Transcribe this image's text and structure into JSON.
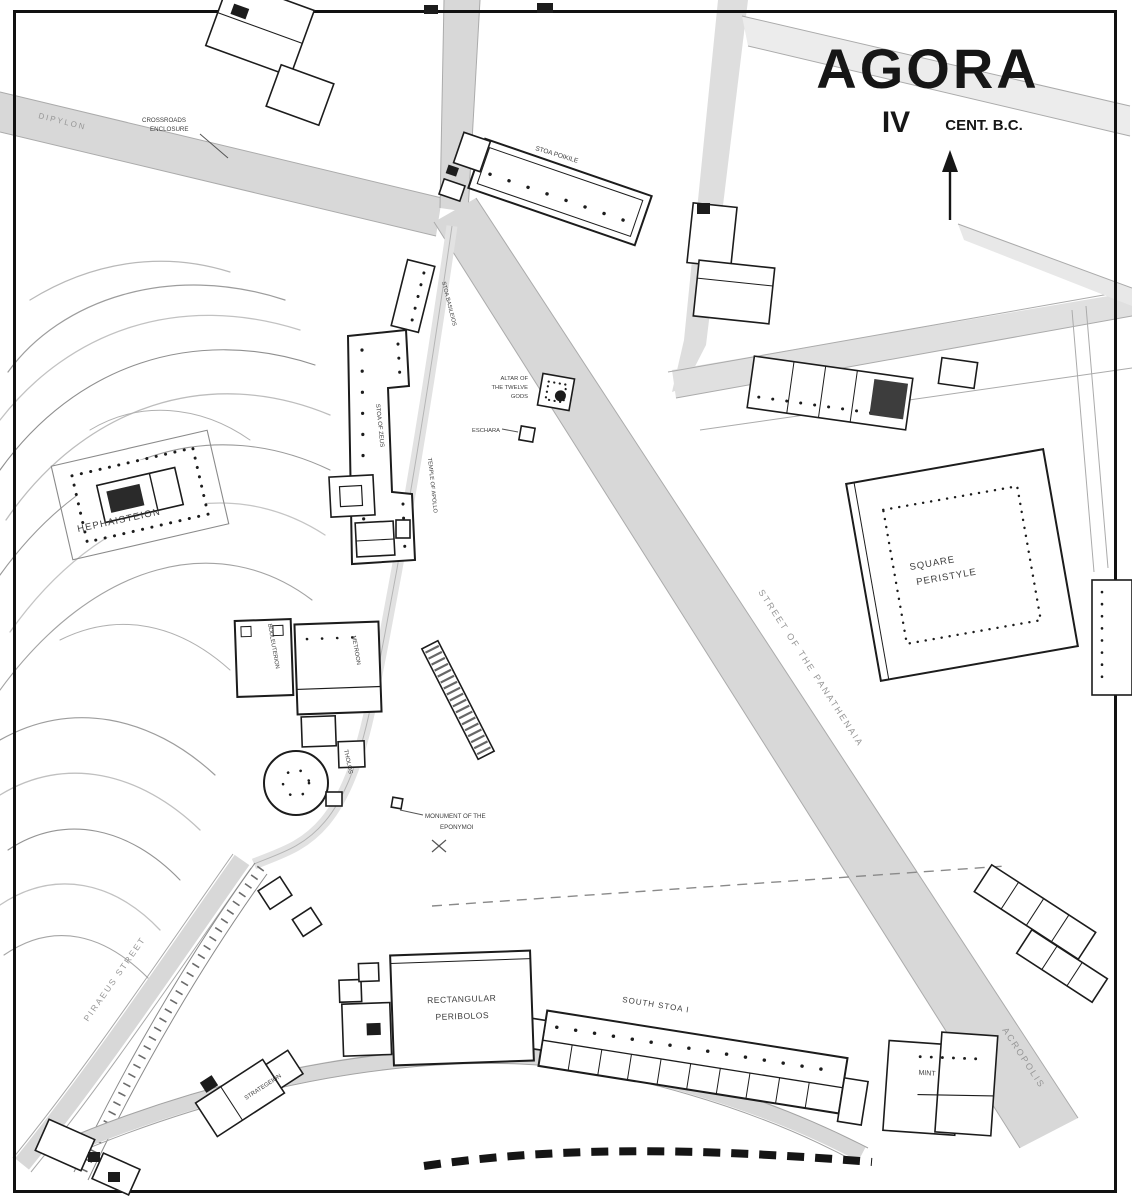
{
  "title": {
    "main": "AGORA",
    "century": "IV",
    "cent_suffix": "CENT. B.C."
  },
  "labels": {
    "crossroads_1": "CROSSROADS",
    "crossroads_2": "ENCLOSURE",
    "stoa_poikile": "STOA POIKILE",
    "stoa_basileios": "STOA BASILEIOS",
    "altar_1": "ALTAR OF",
    "altar_2": "THE TWELVE",
    "altar_3": "GODS",
    "eschara": "ESCHARA",
    "stoa_of_zeus": "STOA OF ZEUS",
    "apollo_patroos": "TEMPLE OF APOLLO",
    "metroon": "METROON",
    "bouleuterion": "BOULEUTERION",
    "tholos": "THOLOS",
    "eponymoi_1": "MONUMENT OF THE",
    "eponymoi_2": "EPONYMOI",
    "hephaisteion": "HEPHAISTEION",
    "square_peristyle_1": "SQUARE",
    "square_peristyle_2": "PERISTYLE",
    "peribolos_1": "RECTANGULAR",
    "peribolos_2": "PERIBOLOS",
    "south_stoa": "SOUTH STOA I",
    "mint": "MINT",
    "strategeion": "STRATEGEION"
  },
  "street_labels": {
    "panathenaia": "STREET OF THE PANATHENAIA",
    "acropolis": "ACROPOLIS",
    "piraeus": "PIRAEUS STREET",
    "dipylon": "DIPYLON"
  },
  "colors": {
    "road": "#d8d8d8",
    "ink": "#1c1c1c",
    "street_text": "#969696"
  }
}
